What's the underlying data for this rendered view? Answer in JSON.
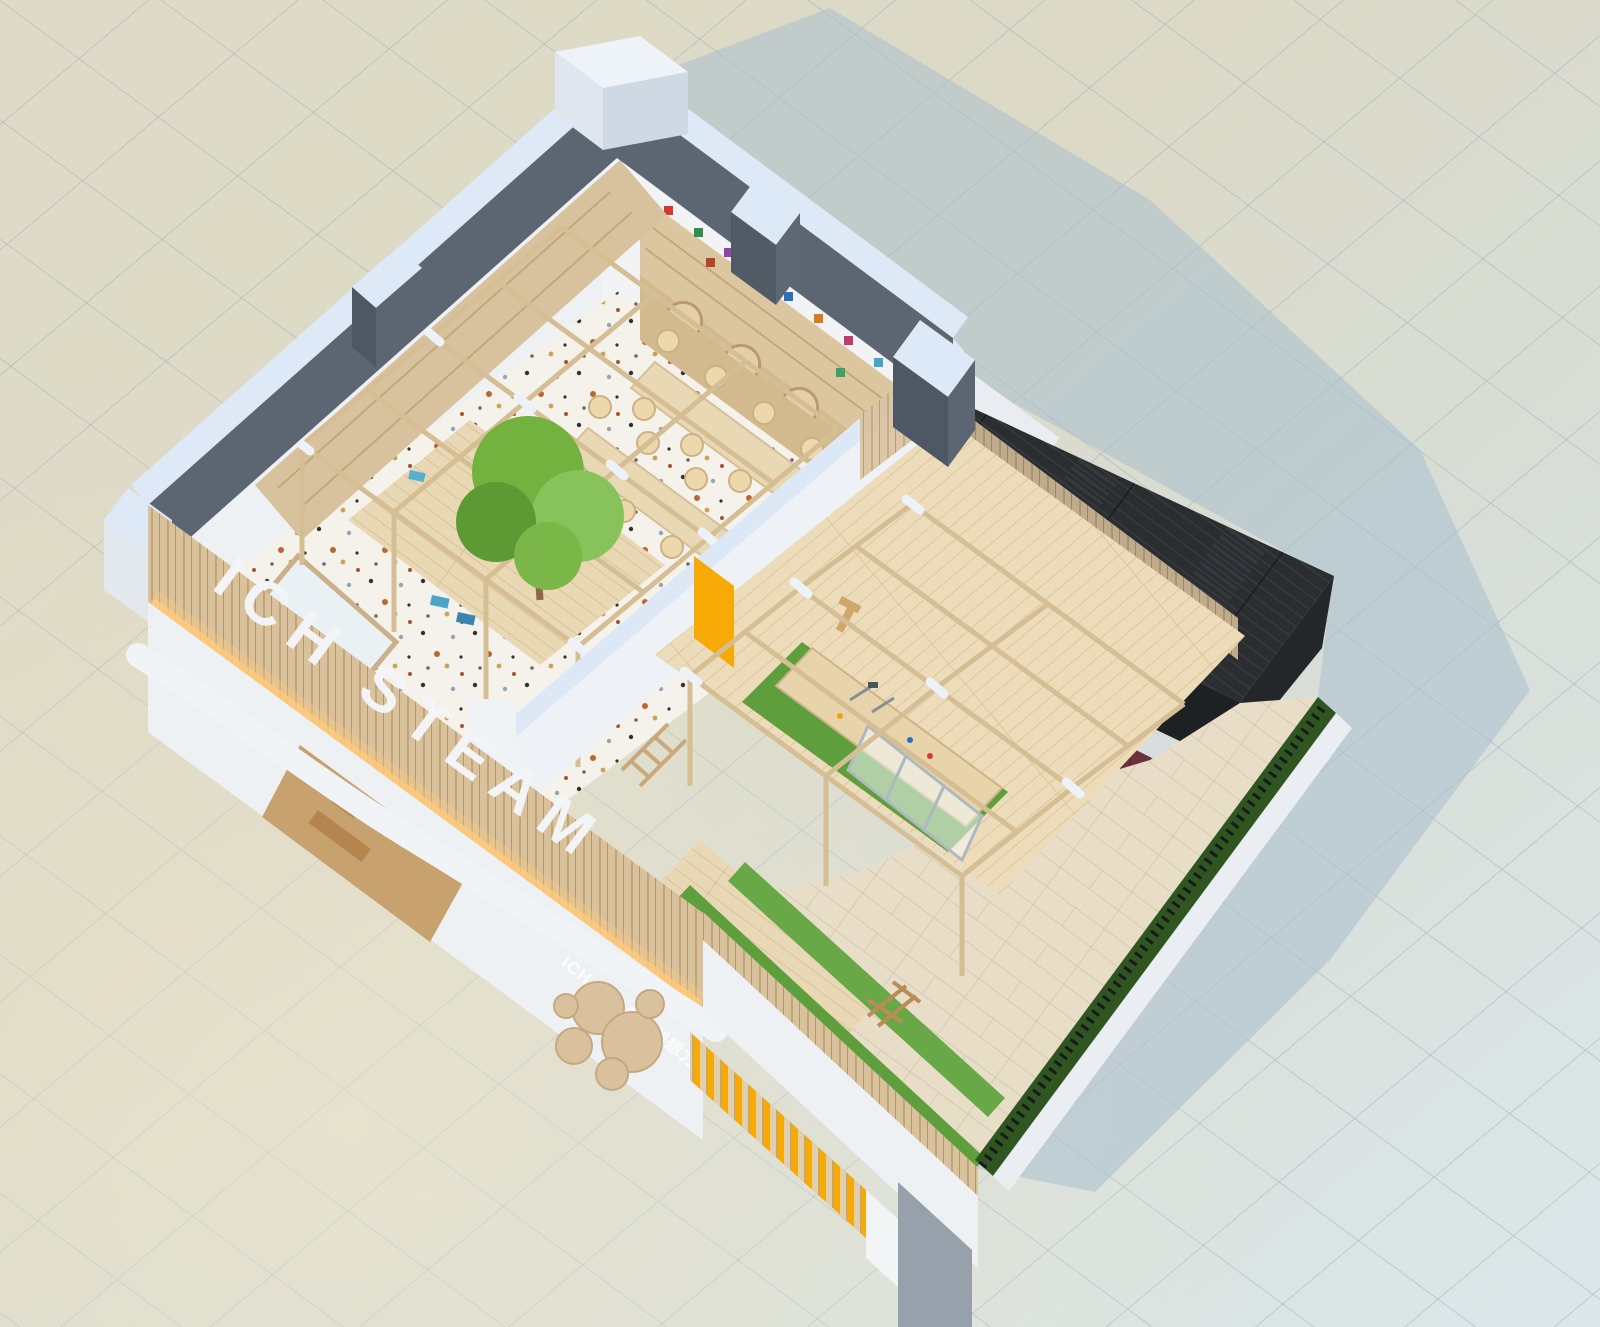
{
  "scene": {
    "description": "Isometric aerial cutaway render of a children's STEAM education center model on a tiled ground plane",
    "branding": {
      "facade_letters": "ICH STEAM",
      "sign_text": "ICH STEAM 创想力工坊"
    },
    "palette": {
      "ground_tile_warm": "#dedac7",
      "ground_tile_cool": "#dbe7ea",
      "ground_grid_line": "#9fb0be",
      "cast_shadow_blue": "#aabfce",
      "wall_cap_ice_blue": "#dde9f6",
      "wall_outer_dark_gray": "#5b6672",
      "wall_white": "#eef1f4",
      "wood_slat": "#d9c19c",
      "wood_floor": "#e7d6b2",
      "terrazzo_base": "#f5f2ec",
      "turf_green": "#5f9e3d",
      "hedge_green": "#2f5620",
      "black_timber_box": "#2a2d30",
      "accent_yellow": "#f7a906",
      "tree_green": "#7ab648",
      "warm_glow": "#ffca7a"
    }
  }
}
